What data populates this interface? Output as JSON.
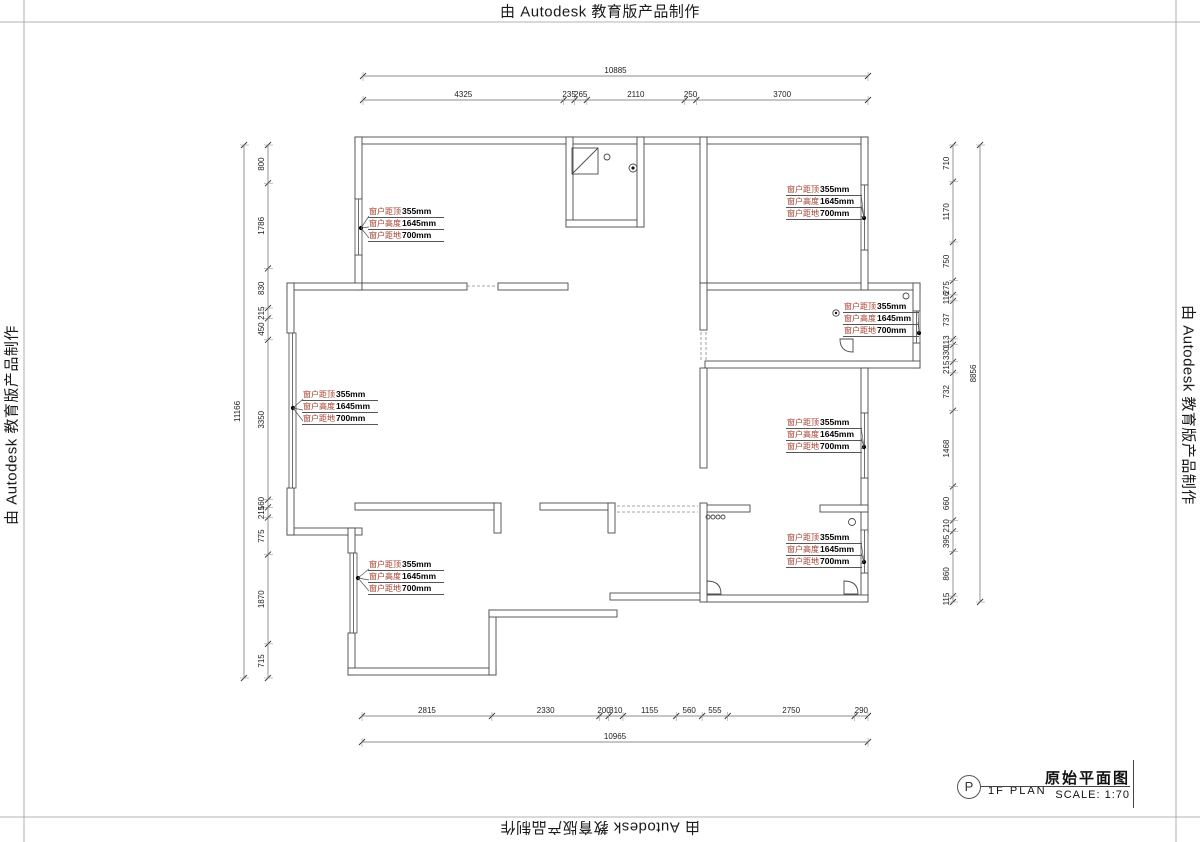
{
  "watermarks": {
    "top": "由 Autodesk 教育版产品制作",
    "bottom": "由 Autodesk 教育版产品制作",
    "left": "由 Autodesk 教育版产品制作",
    "right": "由 Autodesk 教育版产品制作"
  },
  "title_block": {
    "symbol_letter": "P",
    "plan_label": "1F PLAN",
    "drawing_title": "原始平面图",
    "scale_label": "SCALE: 1:70"
  },
  "window_annotation_lines": [
    {
      "label": "窗户距顶",
      "value": "355mm"
    },
    {
      "label": "窗户高度",
      "value": "1645mm"
    },
    {
      "label": "窗户距地",
      "value": "700mm"
    }
  ],
  "annotation_count": 7,
  "colors": {
    "annotation_label": "#a33b2a",
    "annotation_value": "#000000",
    "line": "#4a4a4a"
  },
  "dimensions": {
    "top": {
      "overall": "10885",
      "segments": [
        "4325",
        "235",
        "265",
        "2110",
        "250",
        "3700"
      ]
    },
    "bottom": {
      "overall": "10965",
      "segments": [
        "2815",
        "2330",
        "200",
        "310",
        "1155",
        "560",
        "555",
        "2750",
        "290"
      ]
    },
    "left": {
      "overall": "11166",
      "segments": [
        "800",
        "1786",
        "830",
        "215",
        "450",
        "3350",
        "160",
        "215",
        "775",
        "1870",
        "715"
      ]
    },
    "right": {
      "overall": "8856",
      "segments": [
        "710",
        "1170",
        "750",
        "275",
        "116",
        "737",
        "113",
        "330",
        "215",
        "732",
        "1468",
        "660",
        "210",
        "395",
        "860",
        "115"
      ]
    }
  }
}
